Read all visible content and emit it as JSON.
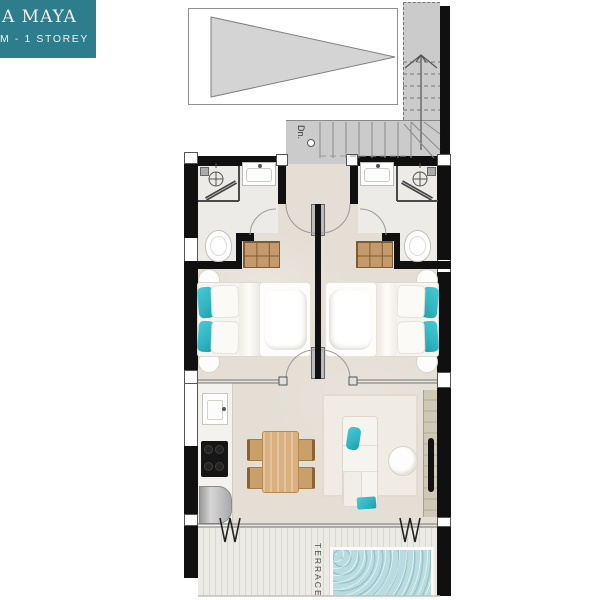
{
  "header": {
    "project_label_line1": "A MAYA",
    "project_label_line2": "M - 1 STOREY"
  },
  "annotations": {
    "stair_direction": "Dn.",
    "terrace": "TERRACE"
  },
  "colors": {
    "label_teal": "#2E7D8C",
    "label_text": "#F2EFE9",
    "wall": "#101010",
    "stair_gray": "#CBCBCB",
    "roof_triangle": "#D4D4D4",
    "floor_beige": "#E4DED4",
    "bath_floor": "#ECEBE7",
    "accent_teal": "#3BC4CE",
    "wood_dining": "#D9B07E",
    "wood_closet": "#C59A6B",
    "pool_water": "#B9DCE0",
    "deck_light": "#ECEAE4",
    "deck_stripe": "#DBD7CF",
    "sofa_cream": "#F6F4EF",
    "line_gray": "#8A8A8A"
  }
}
